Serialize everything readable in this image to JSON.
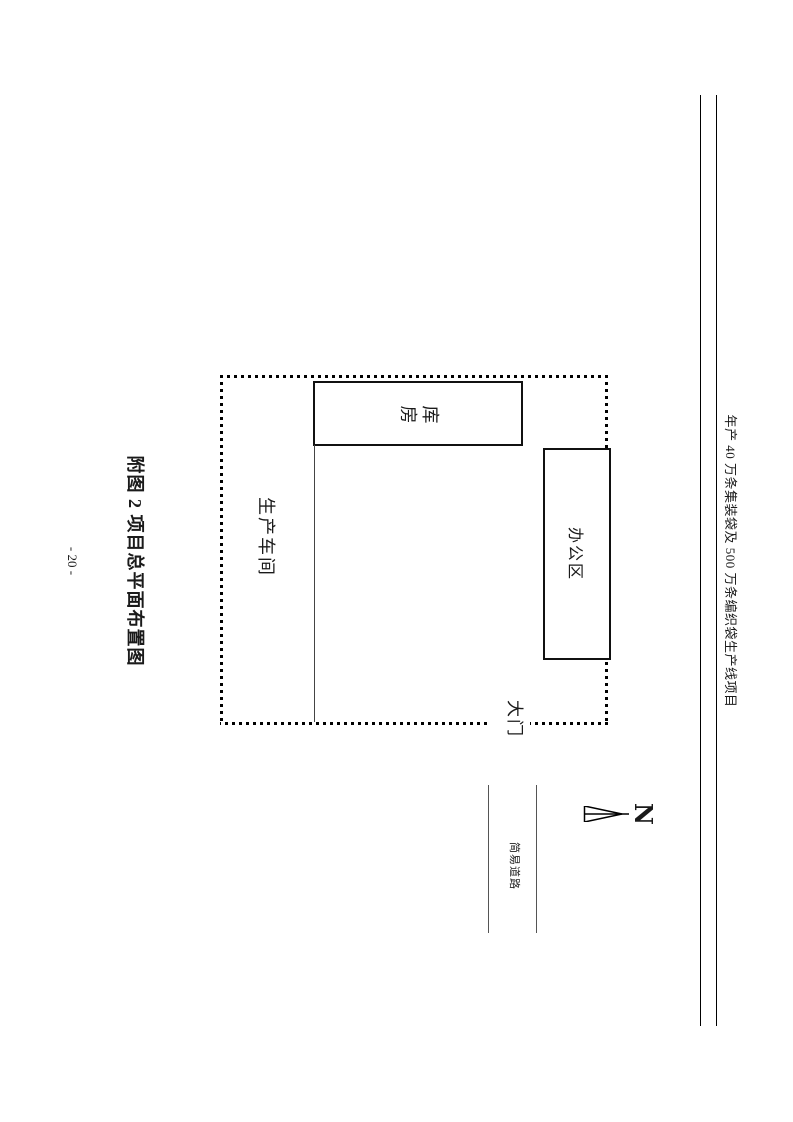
{
  "header": {
    "project_title": "年产 40 万条集装袋及 500 万条编织袋生产线项目"
  },
  "figure": {
    "caption": "附图 2 项目总平面布置图"
  },
  "site_plan": {
    "warehouse_label": "库房",
    "workshop_label": "生产车间",
    "office_label": "办公区",
    "gate_label": "大门",
    "road_label": "简易道路",
    "north_label": "N"
  },
  "footer": {
    "page_number": "- 20 -"
  },
  "icons": {
    "north_arrow": "north-arrow-needle-triangle"
  },
  "colors": {
    "ink": "#1a1a1a",
    "box_border": "#111111",
    "thin_line_gray": "#555555",
    "background": "#ffffff"
  }
}
